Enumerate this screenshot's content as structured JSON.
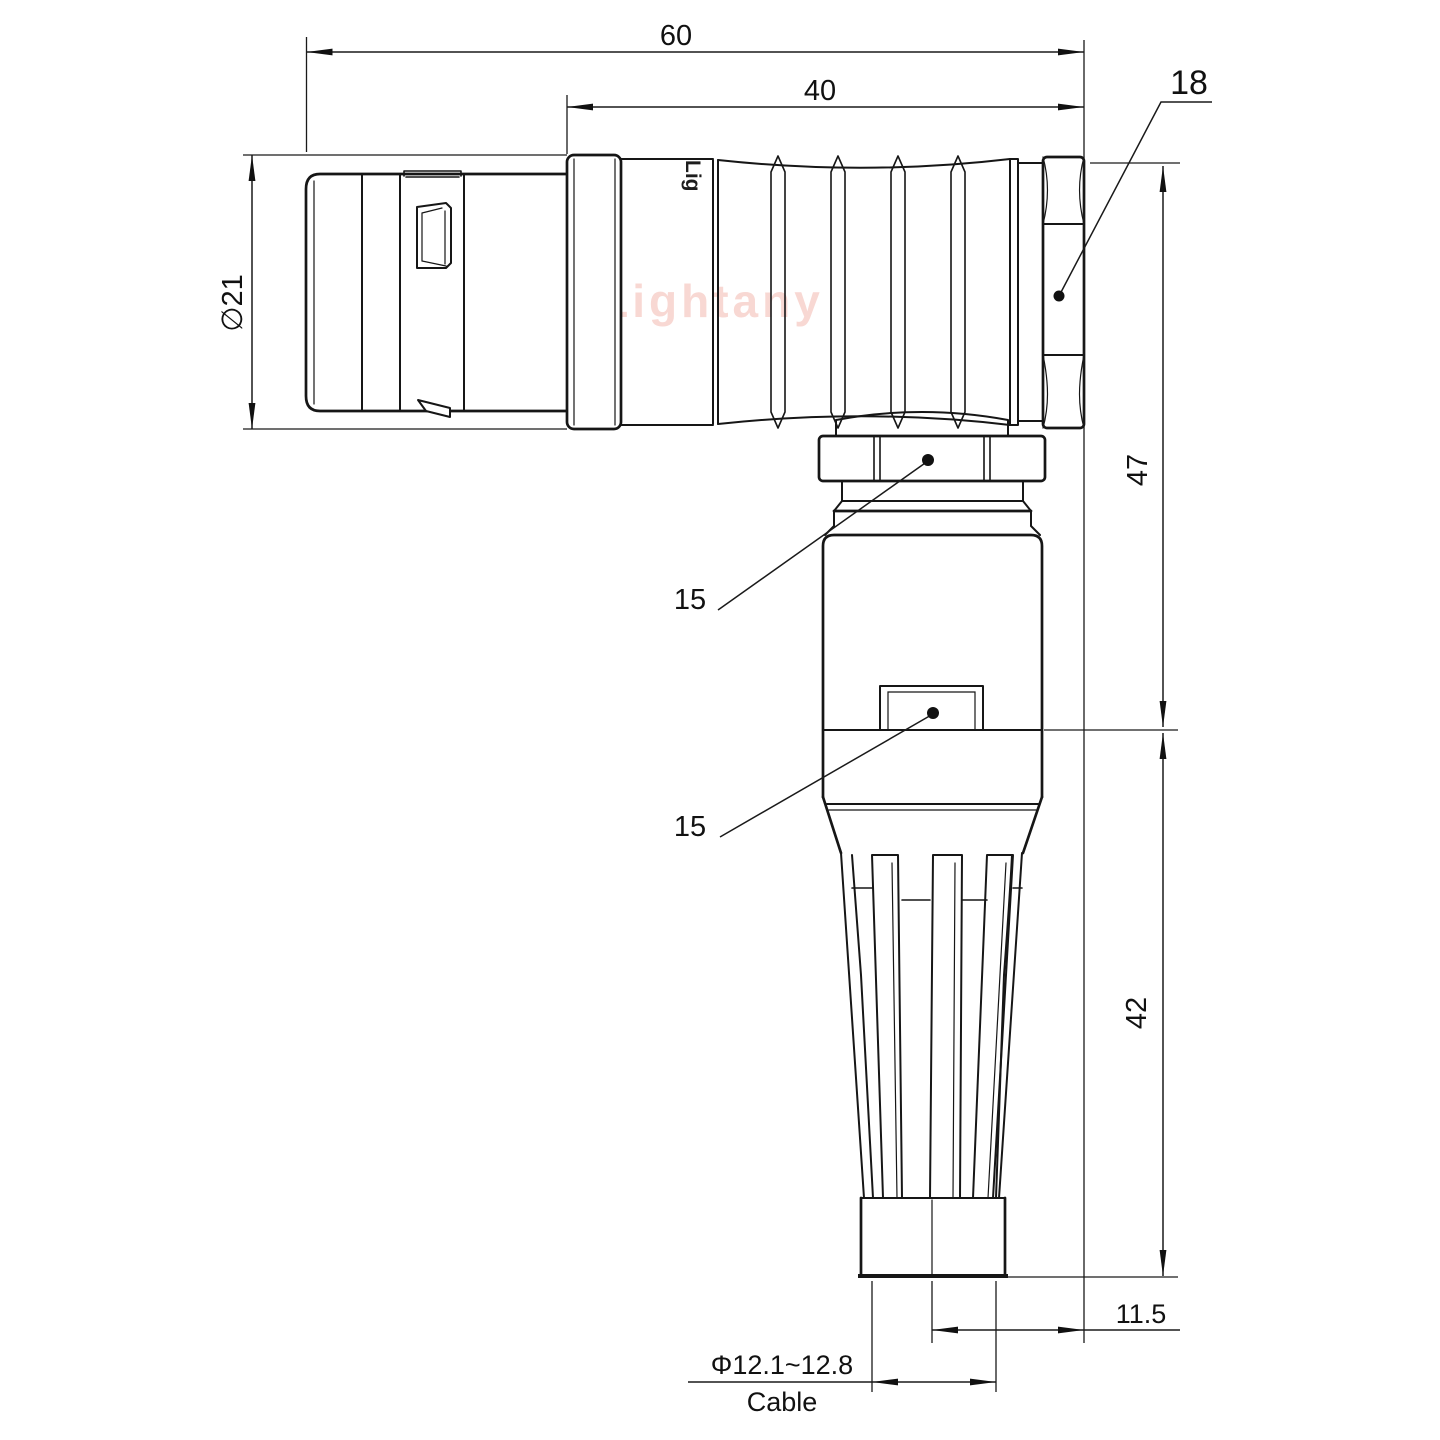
{
  "drawing": {
    "watermark": "Lightany",
    "shell_marking": "Lig",
    "dims": {
      "overall_length": "60",
      "rear_section_length": "40",
      "coupling_nut_flats": "18",
      "shell_diameter": "∅21",
      "upper_height": "47",
      "lower_height": "42",
      "cable_axis_offset": "11.5",
      "cable_diameter_range": "Φ12.1~12.8",
      "cable_caption": "Cable",
      "gland_nut_flats": "15",
      "body_flats": "15"
    },
    "colors": {
      "line": "#161616",
      "watermark": "#f8d4cf",
      "background": "#ffffff"
    }
  }
}
